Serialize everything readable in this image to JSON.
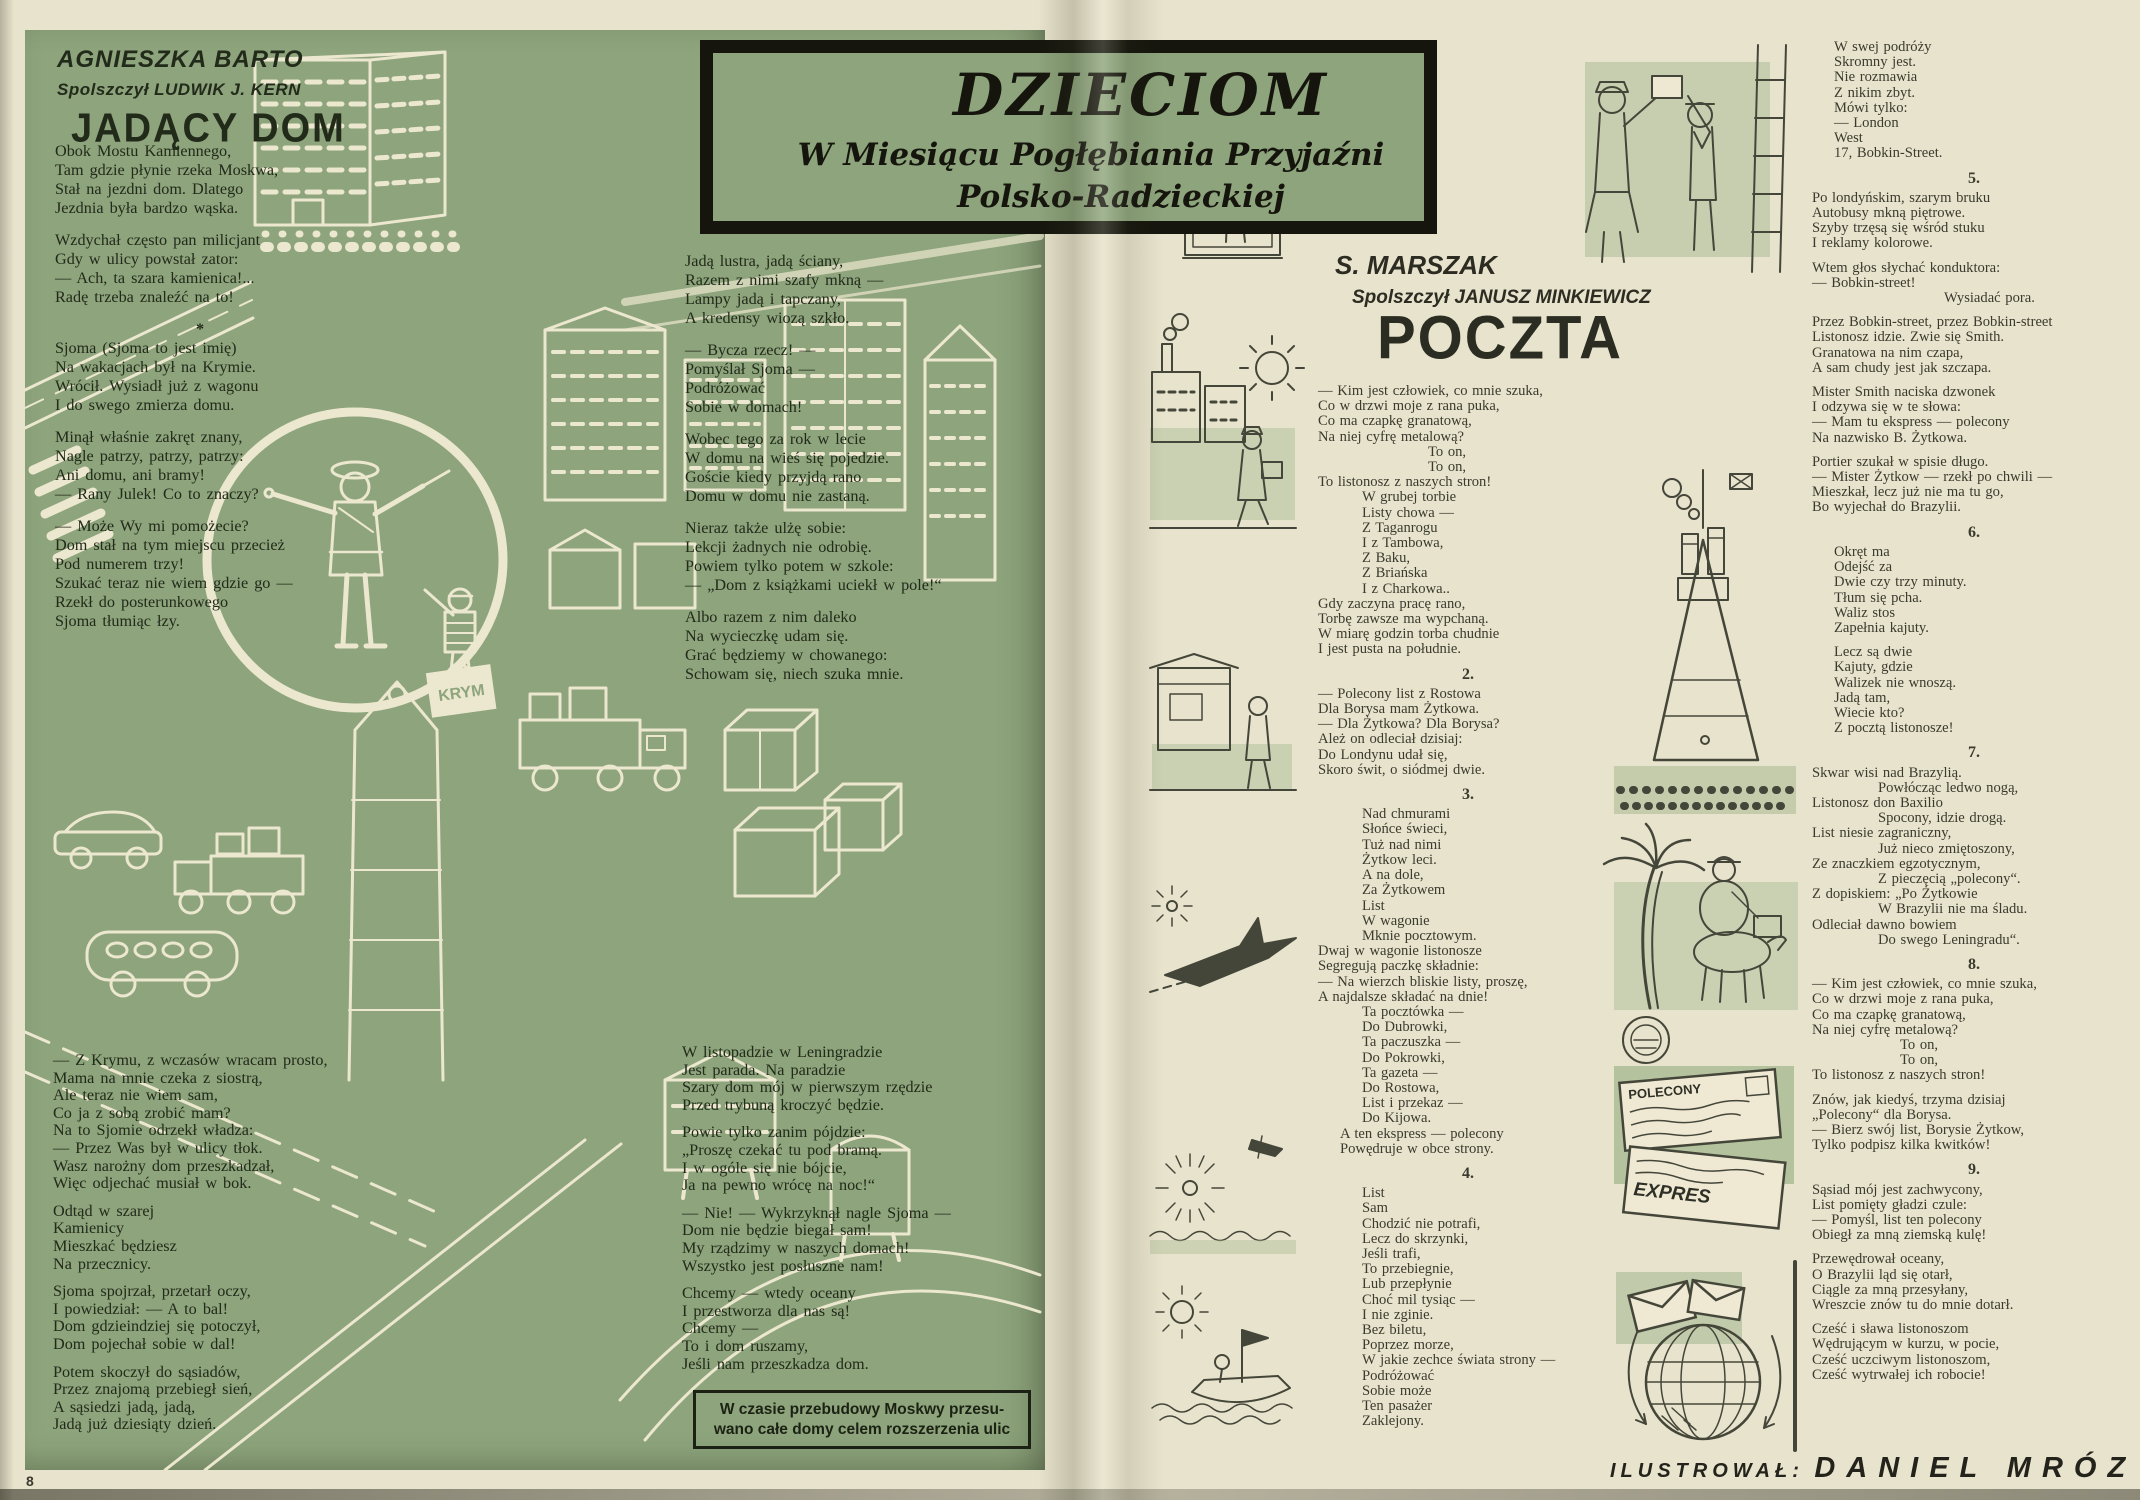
{
  "banner": {
    "title": "DZIECIOM",
    "line1": "W Miesiącu Pogłębiania Przyjaźni",
    "line2": "Polsko-Radzieckiej"
  },
  "left_page": {
    "author": "AGNIESZKA BARTO",
    "translator": "Spolszczył LUDWIK J. KERN",
    "title": "JADĄCY DOM",
    "col1_part1": [
      {
        "lines": [
          "Obok Mostu Kamiennego,",
          "Tam gdzie płynie rzeka Moskwa,",
          "Stał na jezdni dom. Dlatego",
          "Jezdnia była bardzo wąska."
        ]
      },
      {
        "lines": [
          "Wzdychał często pan milicjant",
          "Gdy w ulicy powstał zator:",
          "— Ach, ta szara kamienica!...",
          "Radę trzeba znaleźć na to!"
        ]
      },
      {
        "sep": "*"
      },
      {
        "lines": [
          "Sjoma (Sjoma to jest imię)",
          "Na wakacjach był na Krymie.",
          "Wrócił. Wysiadł już z wagonu",
          "I do swego zmierza domu."
        ]
      },
      {
        "lines": [
          "Minął właśnie zakręt znany,",
          "Nagle patrzy, patrzy, patrzy:",
          "Ani domu, ani bramy!",
          "— Rany Julek! Co to znaczy?"
        ]
      },
      {
        "lines": [
          "— Może Wy mi pomożecie?",
          "Dom stał na tym miejscu przecież",
          "Pod numerem trzy!",
          "Szukać teraz nie wiem gdzie go —",
          "Rzekł do posterunkowego",
          "Sjoma tłumiąc łzy."
        ]
      }
    ],
    "col1_part2": [
      {
        "lines": [
          "— Z Krymu, z wczasów wracam prosto,",
          "Mama na mnie czeka z siostrą,",
          "Ale teraz nie wiem sam,",
          "Co ja z sobą zrobić mam?",
          "Na to Sjomie odrzekł władza:",
          "— Przez Was był w ulicy tłok.",
          "Wasz narożny dom przeszkadzał,",
          "Więc odjechać musiał w bok."
        ]
      },
      {
        "lines": [
          "Odtąd w szarej",
          "Kamienicy",
          "Mieszkać będziesz",
          "Na przecznicy."
        ]
      },
      {
        "lines": [
          "Sjoma spojrzał, przetarł oczy,",
          "I powiedział: — A to bal!",
          "Dom gdzieindziej się potoczył,",
          "Dom pojechał sobie w dal!"
        ]
      },
      {
        "lines": [
          "Potem skoczył do sąsiadów,",
          "Przez znajomą przebiegł sień,",
          "A sąsiedzi jadą, jadą,",
          "Jadą już dziesiąty dzień."
        ]
      }
    ],
    "col2_part1": [
      {
        "lines": [
          "Jadą lustra, jadą ściany,",
          "Razem z nimi szafy mkną —",
          "Lampy jadą i tapczany,",
          "A kredensy wiozą szkło."
        ]
      },
      {
        "lines": [
          "— Bycza rzecz! —",
          "Pomyślał Sjoma —",
          "Podróżować",
          "Sobie w domach!"
        ]
      },
      {
        "lines": [
          "Wobec tego za rok w lecie",
          "W domu na wieś się pojedzie.",
          "Goście kiedy przyjdą rano",
          "Domu w domu nie zastaną."
        ]
      },
      {
        "lines": [
          "Nieraz także ulżę sobie:",
          "Lekcji żadnych nie odrobię.",
          "Powiem tylko potem w szkole:",
          "— „Dom z książkami uciekł w pole!“"
        ]
      },
      {
        "lines": [
          "Albo razem z nim daleko",
          "Na wycieczkę udam się.",
          "Grać będziemy w chowanego:",
          "Schowam się, niech szuka mnie."
        ]
      }
    ],
    "col2_part2": [
      {
        "lines": [
          "W listopadzie w Leningradzie",
          "Jest parada. Na paradzie",
          "Szary dom mój w pierwszym rzędzie",
          "Przed trybuną kroczyć będzie."
        ]
      },
      {
        "lines": [
          "Powie tylko zanim pójdzie:",
          "„Proszę czekać tu pod bramą.",
          "I w ogóle się nie bójcie,",
          "Ja na pewno wrócę na noc!“"
        ]
      },
      {
        "lines": [
          "— Nie! — Wykrzyknął nagle Sjoma —",
          "Dom nie będzie biegał sam!",
          "My rządzimy w naszych domach!",
          "Wszystko jest posłuszne nam!"
        ]
      },
      {
        "lines": [
          "Chcemy — wtedy oceany",
          "I przestworza dla nas są!",
          "Chcemy —",
          "To i dom ruszamy,",
          "Jeśli nam przeszkadza dom."
        ]
      }
    ],
    "footnote_line1": "W czasie przebudowy Moskwy przesu-",
    "footnote_line2": "wano całe domy celem rozszerzenia ulic"
  },
  "right_page": {
    "author": "S. MARSZAK",
    "translator": "Spolszczył JANUSZ MINKIEWICZ",
    "title": "POCZTA",
    "colA": [
      {
        "lines": [
          "— Kim jest człowiek, co mnie szuka,",
          "Co w drzwi moje z rana puka,",
          "Co ma czapkę granatową,",
          "Na niej cyfrę metalową?",
          {
            "t": "To on,",
            "i": 5
          },
          {
            "t": "To on,",
            "i": 5
          },
          "To listonosz z naszych stron!",
          {
            "t": "W grubej torbie",
            "i": 2
          },
          {
            "t": "Listy chowa —",
            "i": 2
          },
          {
            "t": "Z Taganrogu",
            "i": 2
          },
          {
            "t": "I z Tambowa,",
            "i": 2
          },
          {
            "t": "Z Baku,",
            "i": 2
          },
          {
            "t": "Z Briańska",
            "i": 2
          },
          {
            "t": "I z Charkowa..",
            "i": 2
          },
          "Gdy zaczyna pracę rano,",
          "Torbę zawsze ma wypchaną.",
          "W miarę godzin torba chudnie",
          "I jest pusta na południe."
        ]
      },
      {
        "num": "2."
      },
      {
        "lines": [
          "— Polecony list z Rostowa",
          "Dla Borysa mam Żytkowa.",
          "— Dla Żytkowa? Dla Borysa?",
          "Ależ on odleciał dzisiaj:",
          "Do Londynu udał się,",
          "Skoro świt, o siódmej dwie."
        ]
      },
      {
        "num": "3."
      },
      {
        "lines": [
          {
            "t": "Nad chmurami",
            "i": 2
          },
          {
            "t": "Słońce świeci,",
            "i": 2
          },
          {
            "t": "Tuż nad nimi",
            "i": 2
          },
          {
            "t": "Żytkow leci.",
            "i": 2
          },
          {
            "t": "A na dole,",
            "i": 2
          },
          {
            "t": "Za Żytkowem",
            "i": 2
          },
          {
            "t": "List",
            "i": 2
          },
          {
            "t": "W wagonie",
            "i": 2
          },
          {
            "t": "Mknie pocztowym.",
            "i": 2
          },
          "Dwaj w wagonie listonosze",
          "Segregują paczkę składnie:",
          "— Na wierzch bliskie listy, proszę,",
          "A najdalsze składać na dnie!",
          {
            "t": "Ta pocztówka —",
            "i": 2
          },
          {
            "t": "Do Dubrowki,",
            "i": 2
          },
          {
            "t": "Ta paczuszka —",
            "i": 2
          },
          {
            "t": "Do Pokrowki,",
            "i": 2
          },
          {
            "t": "Ta gazeta —",
            "i": 2
          },
          {
            "t": "Do Rostowa,",
            "i": 2
          },
          {
            "t": "List i przekaz —",
            "i": 2
          },
          {
            "t": "Do Kijowa.",
            "i": 2
          },
          {
            "t": "A ten ekspress — polecony",
            "i": 1
          },
          {
            "t": "Powędruje w obce strony.",
            "i": 1
          }
        ]
      },
      {
        "num": "4."
      },
      {
        "lines": [
          {
            "t": "List",
            "i": 2
          },
          {
            "t": "Sam",
            "i": 2
          },
          {
            "t": "Chodzić nie potrafi,",
            "i": 2
          },
          {
            "t": "Lecz do skrzynki,",
            "i": 2
          },
          {
            "t": "Jeśli trafi,",
            "i": 2
          },
          {
            "t": "To przebiegnie,",
            "i": 2
          },
          {
            "t": "Lub przepłynie",
            "i": 2
          },
          {
            "t": "Choć mil tysiąc —",
            "i": 2
          },
          {
            "t": "I nie zginie.",
            "i": 2
          },
          {
            "t": "Bez biletu,",
            "i": 2
          },
          {
            "t": "Poprzez morze,",
            "i": 2
          },
          {
            "t": "W jakie zechce świata strony —",
            "i": 2
          },
          {
            "t": "Podróżować",
            "i": 2
          },
          {
            "t": "Sobie może",
            "i": 2
          },
          {
            "t": "Ten pasażer",
            "i": 2
          },
          {
            "t": "Zaklejony.",
            "i": 2
          }
        ]
      }
    ],
    "colB": [
      {
        "lines": [
          {
            "t": "W swej podróży",
            "i": 1
          },
          {
            "t": "Skromny jest.",
            "i": 1
          },
          {
            "t": "Nie rozmawia",
            "i": 1
          },
          {
            "t": "Z nikim zbyt.",
            "i": 1
          },
          {
            "t": "Mówi tylko:",
            "i": 1
          },
          {
            "t": "— London",
            "i": 1
          },
          {
            "t": "West",
            "i": 1
          },
          {
            "t": "17, Bobkin-Street.",
            "i": 1
          }
        ]
      },
      {
        "num": "5."
      },
      {
        "lines": [
          "Po londyńskim, szarym bruku",
          "Autobusy mkną piętrowe.",
          "Szyby trzęsą się wśród stuku",
          "I reklamy kolorowe."
        ]
      },
      {
        "lines": [
          "Wtem głos słychać konduktora:",
          "— Bobkin-street!",
          {
            "t": "Wysiadać pora.",
            "i": 6
          }
        ]
      },
      {
        "lines": [
          "Przez Bobkin-street, przez Bobkin-street",
          "Listonosz idzie. Zwie się Smith.",
          "Granatowa na nim czapa,",
          "A sam chudy jest jak szczapa."
        ]
      },
      {
        "lines": [
          "Mister Smith naciska dzwonek",
          "I odzywa się w te słowa:",
          "— Mam tu ekspress — polecony",
          "Na nazwisko B. Żytkowa."
        ]
      },
      {
        "lines": [
          "Portier szukał w spisie długo.",
          "— Mister Żytkow — rzekł po chwili —",
          "Mieszkał, lecz już nie ma tu go,",
          "Bo wyjechał do Brazylii."
        ]
      },
      {
        "num": "6."
      },
      {
        "lines": [
          {
            "t": "Okręt ma",
            "i": 1
          },
          {
            "t": "Odejść za",
            "i": 1
          },
          {
            "t": "Dwie czy trzy minuty.",
            "i": 1
          },
          {
            "t": "Tłum się pcha.",
            "i": 1
          },
          {
            "t": "Waliz stos",
            "i": 1
          },
          {
            "t": "Zapełnia kajuty.",
            "i": 1
          }
        ]
      },
      {
        "lines": [
          {
            "t": "Lecz są dwie",
            "i": 1
          },
          {
            "t": "Kajuty, gdzie",
            "i": 1
          },
          {
            "t": "Walizek nie wnoszą.",
            "i": 1
          },
          {
            "t": "Jadą tam,",
            "i": 1
          },
          {
            "t": "Wiecie kto?",
            "i": 1
          },
          {
            "t": "Z pocztą listonosze!",
            "i": 1
          }
        ]
      },
      {
        "num": "7."
      },
      {
        "lines": [
          "Skwar wisi nad Brazylią.",
          {
            "t": "Powłócząc ledwo nogą,",
            "i": 3
          },
          "Listonosz don Baxilio",
          {
            "t": "Spocony, idzie drogą.",
            "i": 3
          },
          "List niesie zagraniczny,",
          {
            "t": "Już nieco zmiętoszony,",
            "i": 3
          },
          "Ze znaczkiem egzotycznym,",
          {
            "t": "Z pieczęcią „polecony“.",
            "i": 3
          },
          "Z dopiskiem: „Po Żytkowie",
          {
            "t": "W Brazylii nie ma śladu.",
            "i": 3
          },
          "Odleciał dawno bowiem",
          {
            "t": "Do swego Leningradu“.",
            "i": 3
          }
        ]
      },
      {
        "num": "8."
      },
      {
        "lines": [
          "— Kim jest człowiek, co mnie szuka,",
          "Co w drzwi moje z rana puka,",
          "Co ma czapkę granatową,",
          "Na niej cyfrę metalową?",
          {
            "t": "To on,",
            "i": 4
          },
          {
            "t": "To on,",
            "i": 4
          },
          "To listonosz z naszych stron!"
        ]
      },
      {
        "lines": [
          "Znów, jak kiedyś, trzyma dzisiaj",
          "„Polecony“ dla Borysa.",
          "— Bierz swój list, Borysie Żytkow,",
          "Tylko podpisz kilka kwitków!"
        ]
      },
      {
        "num": "9."
      },
      {
        "lines": [
          "Sąsiad mój jest zachwycony,",
          "List pomięty gładzi czule:",
          "— Pomyśl, list ten polecony",
          "Obiegł za mną ziemską kulę!"
        ]
      },
      {
        "lines": [
          "Przewędrował oceany,",
          "O Brazylii ląd się otarł,",
          "Ciągle za mną przesyłany,",
          "Wreszcie znów tu do mnie dotarł."
        ]
      },
      {
        "lines": [
          "Cześć i sława listonoszom",
          "Wędrującym w kurzu, w pocie,",
          "Cześć uczciwym listonoszom,",
          "Cześć wytrwałej ich robocie!"
        ]
      }
    ]
  },
  "footer": {
    "page_number": "8",
    "credit_label": "ILUSTROWAŁ:",
    "credit_name": "DANIEL MRÓZ"
  },
  "illustrations": {
    "suitcase_label": "KRYM",
    "stamp_registered": "POLECONY",
    "stamp_express": "EXPRES"
  }
}
